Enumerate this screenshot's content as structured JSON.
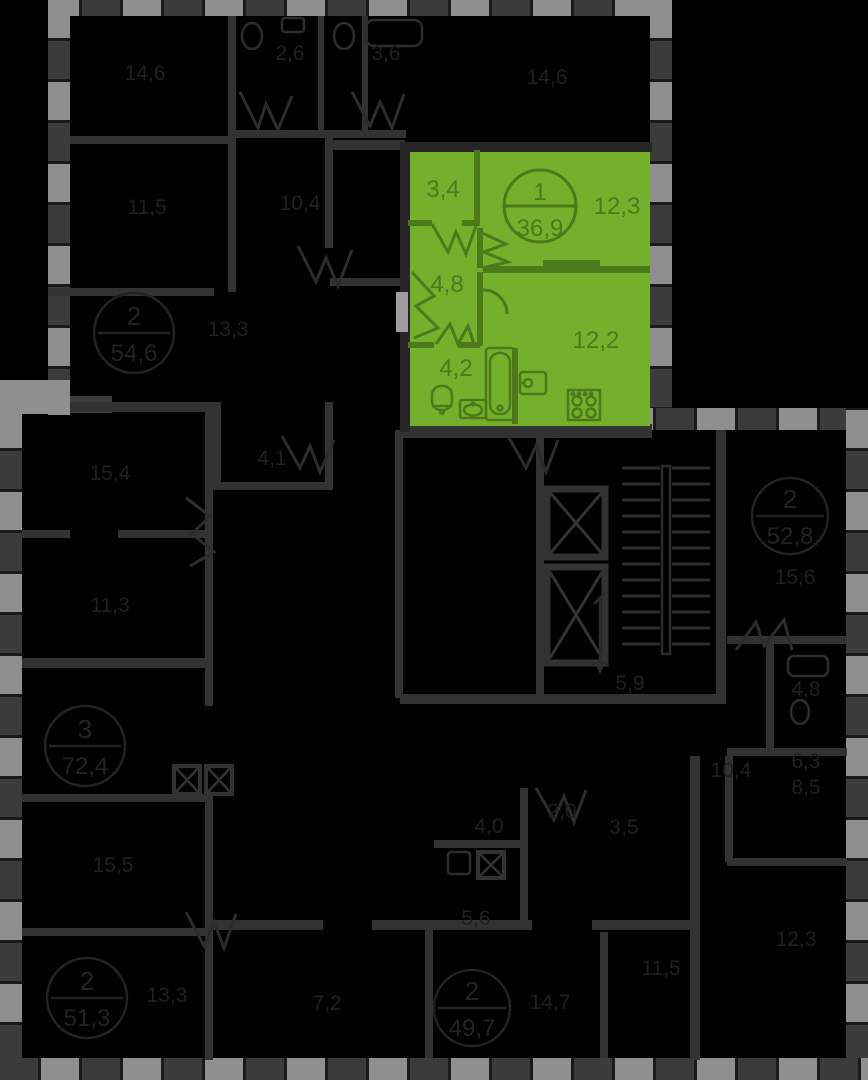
{
  "page_title": "Floor plan — selected apartment",
  "colors": {
    "background": "#000000",
    "selected_unit_fill": "#74B02C",
    "selected_unit_lines": "#4C7A1B",
    "plan_walls": "#323232",
    "perimeter_light": "#8F8F8F",
    "perimeter_dark": "#3B3B3B",
    "faint_text": "#1f1f1f",
    "entry_door": "#9E9E9E"
  },
  "unit": {
    "badge": {
      "rooms_count": "1",
      "total_area": "36,9"
    },
    "rooms": [
      {
        "name": "wardrobe-hall",
        "area": "3,4"
      },
      {
        "name": "living-room",
        "area": "12,3"
      },
      {
        "name": "hallway",
        "area": "4,8"
      },
      {
        "name": "bathroom",
        "area": "4,2"
      },
      {
        "name": "kitchen",
        "area": "12,2"
      }
    ],
    "fixture_icons": [
      "bathtub-icon",
      "toilet-icon",
      "sink-icon",
      "washing-machine-icon",
      "stove-icon"
    ]
  },
  "background_plan": {
    "badges": [
      {
        "x": 134,
        "y": 333,
        "r": 40,
        "rooms_count": "2",
        "total_area": "54,6"
      },
      {
        "x": 790,
        "y": 516,
        "r": 38,
        "rooms_count": "2",
        "total_area": "52,8"
      },
      {
        "x": 85,
        "y": 746,
        "r": 40,
        "rooms_count": "3",
        "total_area": "72,4"
      },
      {
        "x": 87,
        "y": 998,
        "r": 40,
        "rooms_count": "2",
        "total_area": "51,3"
      },
      {
        "x": 472,
        "y": 1008,
        "r": 38,
        "rooms_count": "2",
        "total_area": "49,7"
      }
    ],
    "room_labels": [
      {
        "text": "14,6",
        "x": 145,
        "y": 80
      },
      {
        "text": "2,6",
        "x": 290,
        "y": 60
      },
      {
        "text": "3,6",
        "x": 386,
        "y": 60
      },
      {
        "text": "14,6",
        "x": 547,
        "y": 84
      },
      {
        "text": "11,5",
        "x": 147,
        "y": 214
      },
      {
        "text": "10,4",
        "x": 300,
        "y": 210
      },
      {
        "text": "13,3",
        "x": 228,
        "y": 336
      },
      {
        "text": "15,4",
        "x": 110,
        "y": 480
      },
      {
        "text": "4,1",
        "x": 272,
        "y": 465
      },
      {
        "text": "11,3",
        "x": 110,
        "y": 612
      },
      {
        "text": "15,6",
        "x": 795,
        "y": 584
      },
      {
        "text": "4,8",
        "x": 806,
        "y": 696
      },
      {
        "text": "5,9",
        "x": 630,
        "y": 690
      },
      {
        "text": "15,5",
        "x": 113,
        "y": 872
      },
      {
        "text": "10,4",
        "x": 731,
        "y": 777
      },
      {
        "text": "6,3",
        "x": 806,
        "y": 768
      },
      {
        "text": "8,5",
        "x": 806,
        "y": 794
      },
      {
        "text": "2,0",
        "x": 562,
        "y": 818
      },
      {
        "text": "3,5",
        "x": 624,
        "y": 834
      },
      {
        "text": "4,0",
        "x": 489,
        "y": 833
      },
      {
        "text": "5,6",
        "x": 476,
        "y": 925
      },
      {
        "text": "13,3",
        "x": 167,
        "y": 1002
      },
      {
        "text": "7,2",
        "x": 327,
        "y": 1010
      },
      {
        "text": "11,5",
        "x": 661,
        "y": 975
      },
      {
        "text": "12,3",
        "x": 796,
        "y": 946
      },
      {
        "text": "14,7",
        "x": 550,
        "y": 1009
      }
    ]
  }
}
